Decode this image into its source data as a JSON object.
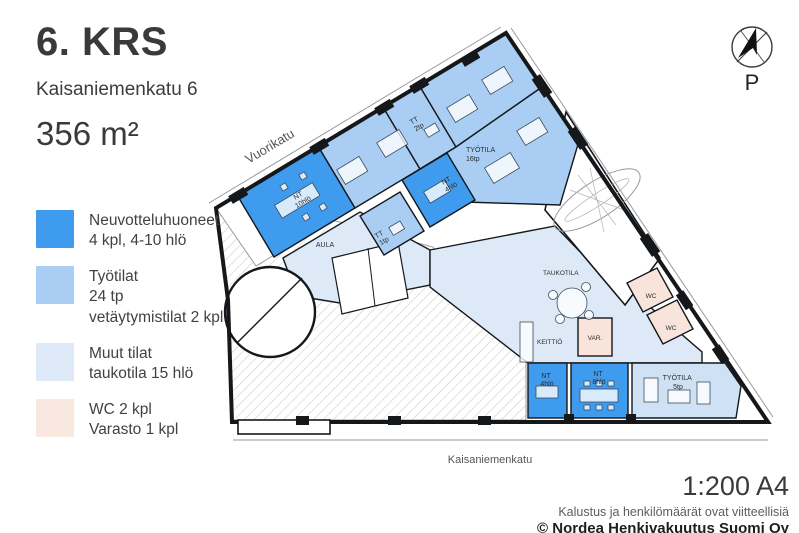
{
  "header": {
    "floor": "6. KRS",
    "address": "Kaisaniemenkatu 6",
    "area": "356 m²"
  },
  "legend": {
    "items": [
      {
        "name": "meeting-rooms",
        "color": "#3f9bee",
        "lines": [
          "Neuvotteluhuoneet",
          "4 kpl, 4-10 hlö"
        ]
      },
      {
        "name": "work-spaces",
        "color": "#a9cdf3",
        "lines": [
          "Työtilat",
          "24 tp",
          "vetäytymistilat 2 kpl"
        ]
      },
      {
        "name": "other-spaces",
        "color": "#dde9f7",
        "lines": [
          "Muut tilat",
          "taukotila 15 hlö"
        ]
      },
      {
        "name": "wc-storage",
        "color": "#f9e8df",
        "lines": [
          "WC 2 kpl",
          "Varasto 1 kpl"
        ]
      }
    ]
  },
  "compass": {
    "label": "P"
  },
  "plan": {
    "streets": {
      "top": "Vuorikatu",
      "bottom": "Kaisaniemenkatu"
    },
    "rooms": {
      "nt10": {
        "abbr": "NT",
        "cap": "10hlö"
      },
      "tt2": {
        "abbr": "TT",
        "cap": "2tp"
      },
      "tt1": {
        "abbr": "TT",
        "cap": "1tp"
      },
      "nt4_center": {
        "abbr": "NT",
        "cap": "4hlö"
      },
      "tyotila16": {
        "abbr": "TYÖTILA",
        "cap": "16tp"
      },
      "aula": {
        "abbr": "AULA"
      },
      "taukotila": {
        "abbr": "TAUKOTILA"
      },
      "keittio": {
        "abbr": "KEITTIÖ"
      },
      "varasto": {
        "abbr": "VAR."
      },
      "wc_a": {
        "abbr": "WC"
      },
      "wc_b": {
        "abbr": "WC"
      },
      "nt4_bottom": {
        "abbr": "NT",
        "cap": "4hlö"
      },
      "nt8": {
        "abbr": "NT",
        "cap": "8hlö"
      },
      "tyotila5": {
        "abbr": "TYÖTILA",
        "cap": "5tp"
      }
    }
  },
  "footer": {
    "scale": "1:200 A4",
    "disclaimer": "Kalustus ja henkilömäärät ovat viitteellisiä",
    "copyright": "© Nordea Henkivakuutus Suomi Oy"
  },
  "colors": {
    "meeting_room": "#3f9bee",
    "work_room": "#a9cdf3",
    "work_room_light": "#cfe2f5",
    "other_room": "#dde9f7",
    "wc_room": "#f8e4da",
    "wall": "#15181b"
  }
}
